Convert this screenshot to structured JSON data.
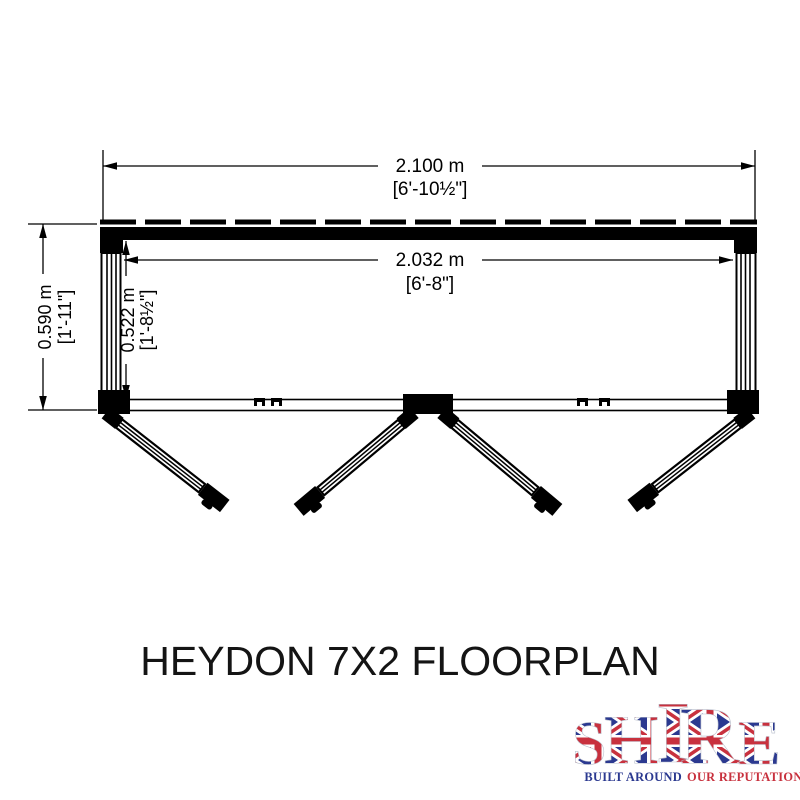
{
  "dimensions": {
    "overall_width": {
      "metric": "2.100 m",
      "imperial": "[6'-10½\"]"
    },
    "internal_width": {
      "metric": "2.032 m",
      "imperial": "[6'-8\"]"
    },
    "overall_depth": {
      "metric": "0.590 m",
      "imperial": "[1'-11\"]"
    },
    "internal_depth": {
      "metric": "0.522 m",
      "imperial": "[1'-8½\"]"
    }
  },
  "title": "HEYDON 7X2 FLOORPLAN",
  "logo": {
    "letters": [
      "S",
      "H",
      "I",
      "R",
      "E"
    ],
    "tagline_part1": "BUILT AROUND",
    "tagline_part2": "OUR REPUTATION",
    "colors": {
      "navy": "#2b3990",
      "red": "#c8313e",
      "white": "#ffffff",
      "letter_outline": "#b9bfcc"
    }
  },
  "drawing": {
    "line_color": "#000000"
  }
}
